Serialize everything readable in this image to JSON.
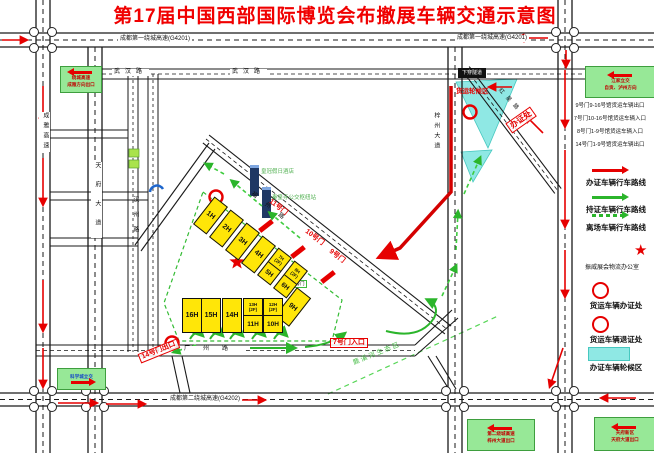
{
  "title": "第17届中国西部国际博览会布撤展车辆交通示意图",
  "roads": {
    "g4201_left": "成都第一绕城高速(G4201)",
    "g4201_right": "成都第一绕城高速(G4201)",
    "g4202": "成都第二绕城高速(G4202)",
    "wuhan_1": "武汉路",
    "wuhan_2": "武汉路",
    "chengya": "成雅高速",
    "tianfu": "天府大道",
    "hanzhou": "汉州路",
    "fuzhou": "福州路",
    "guangzhou": "广州路",
    "zizhou": "梓州大道",
    "hongxing": "红星路",
    "tunnel": "下穿隧道"
  },
  "zones": {
    "freight_wait": "货运轮候区",
    "permit": "办证处",
    "luxi": "鹿溪河生态区"
  },
  "gates": {
    "g11": "11号门",
    "g10": "10号门",
    "g9": "9号门",
    "g8": "8号门",
    "g7": "7号门入口",
    "g14": "14号门出口"
  },
  "pois": {
    "hotel": "皇冠假日酒店",
    "bus_hub": "秦皇寺公交枢纽站"
  },
  "halls": {
    "h1": "1H",
    "h2": "2H",
    "h3": "3H",
    "h4": "4H",
    "h7t": "7H\n(2F)",
    "h5": "5H",
    "h8t": "8H\n(2F)",
    "h6": "6H",
    "h9": "9H",
    "h16": "16H",
    "h15": "15H",
    "h14": "14H",
    "h13t": "13H\n(2F)",
    "h11": "11H",
    "h12t": "12H\n(2F)",
    "h10": "10H"
  },
  "legend": {
    "top_box": {
      "line1": "江家立交",
      "line2": "自贡、泸州方向"
    },
    "notes": [
      "9号门9-16号馆货运车辆出口",
      "7号门10-16号馆货运车辆入口",
      "8号门1-9号馆货运车辆入口",
      "14号门1-9号馆货运车辆出口"
    ],
    "route_permit": "办证车辆行车路线",
    "route_pass": "持证车辆行车路线",
    "route_leave": "离场车辆行车路线",
    "pt_star": "振威展会物流办公室",
    "pt_office": "货运车辆办证处",
    "pt_return": "货运车辆退证处",
    "pt_wait": "办证车辆轮候区",
    "bottom_box": {
      "line1": "天府新区",
      "line2": "天府大道出口"
    }
  },
  "boxes": {
    "top_left": {
      "line1": "绕城高速",
      "line2": "成雅方向出口"
    },
    "bottom_left": {
      "line1": "科学城立交"
    },
    "bottom_center": {
      "line1": "第二绕城高速",
      "line2": "梓州大道出口"
    }
  },
  "glyphs": {
    "star": "★"
  },
  "colors": {
    "accent_red": "#E60000",
    "hall_yellow": "#FFE608",
    "zone_cyan": "#8FE8E4",
    "box_green": "#97E897",
    "route_green": "#2BB52B"
  }
}
